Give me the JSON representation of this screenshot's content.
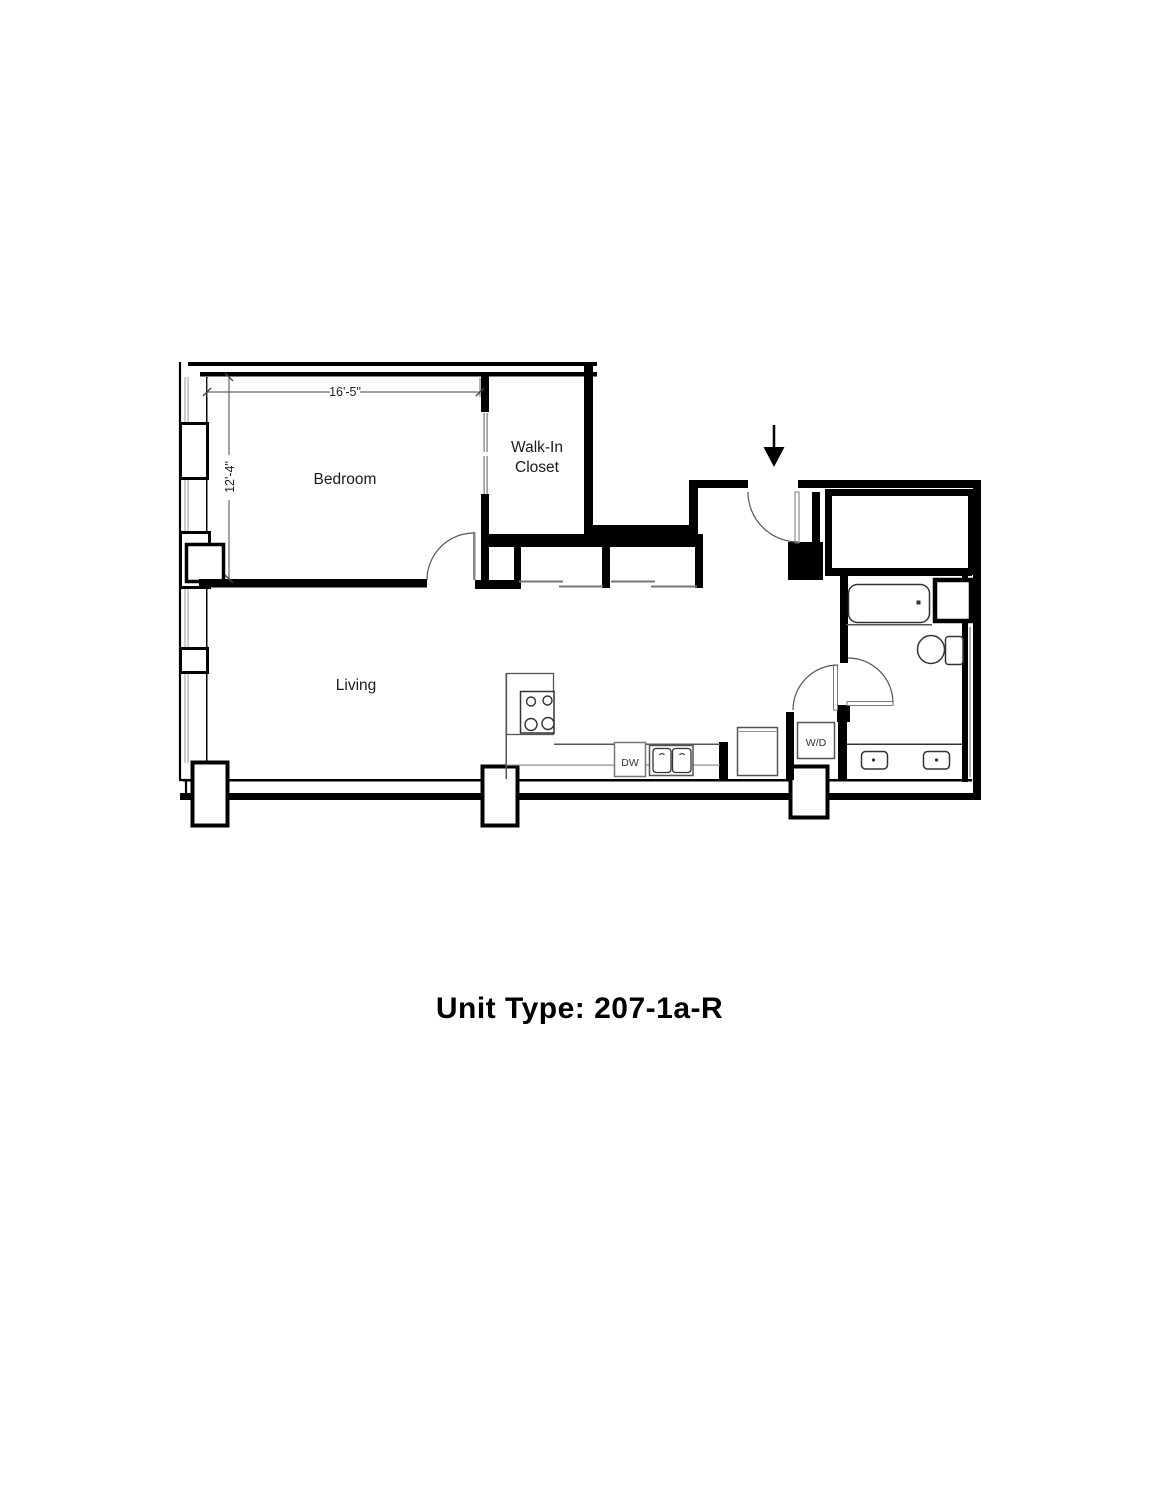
{
  "plan": {
    "title": "Unit Type: 207-1a-R",
    "unit_type": "207-1a-R",
    "labels": {
      "bedroom": "Bedroom",
      "walk_in_closet_line1": "Walk-In",
      "walk_in_closet_line2": "Closet",
      "living": "Living",
      "dishwasher": "DW",
      "washer_dryer": "W/D"
    },
    "dimensions": {
      "bedroom_width": "16'-5\"",
      "bedroom_depth": "12'-4\""
    },
    "colors": {
      "wall": "#000000",
      "fixture_line": "#333333",
      "thin_line": "#777777",
      "background": "#ffffff"
    }
  }
}
